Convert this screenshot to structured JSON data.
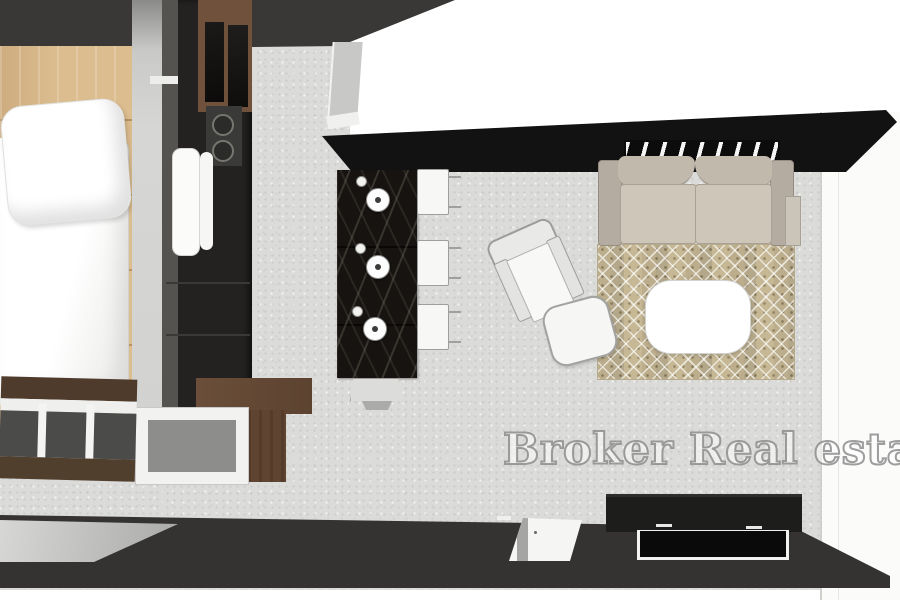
{
  "watermark": {
    "text": "Broker Real estate",
    "fill": "#ffffff",
    "outline": "#8c8c8c"
  },
  "scene": {
    "type": "3d-top-down-floor-plan-render",
    "rooms": [
      {
        "name": "bedroom",
        "items": [
          "bed",
          "pillow",
          "duvet",
          "foot-bench",
          "wardrobe-column",
          "wood-floor"
        ]
      },
      {
        "name": "kitchen",
        "items": [
          "tall-cabinet",
          "oven-knob-panel",
          "fridge-doors",
          "marble-island",
          "pendant-light",
          "pendant-light",
          "pendant-light",
          "bar-stool",
          "bar-stool",
          "bar-stool",
          "end-stool",
          "display-cabinet"
        ]
      },
      {
        "name": "living-room",
        "items": [
          "sofa",
          "wall-vent-grille",
          "area-rug",
          "coffee-table",
          "armchair",
          "ottoman",
          "tv-console",
          "tv-panel",
          "side-unit"
        ]
      },
      {
        "name": "hallway",
        "items": [
          "white-corridor"
        ]
      },
      {
        "name": "south-wall",
        "items": [
          "dark-wall-strip",
          "sliding-door",
          "white-door"
        ]
      }
    ]
  },
  "palette": {
    "wood": "#dcbd8f",
    "wall_dark": "#3a3836",
    "cabinet_dark": "#242220",
    "wood_cabinet": "#6f513c",
    "floor_concrete": "#dbdbd9",
    "wall_black": "#121212",
    "island_marble": "#161310",
    "sofa": "#cfc6ba",
    "sofa_dark": "#b5aca1",
    "rug": "#cfc3a4",
    "white_furniture": "#f6f6f4",
    "strip_dark": "#343332"
  }
}
